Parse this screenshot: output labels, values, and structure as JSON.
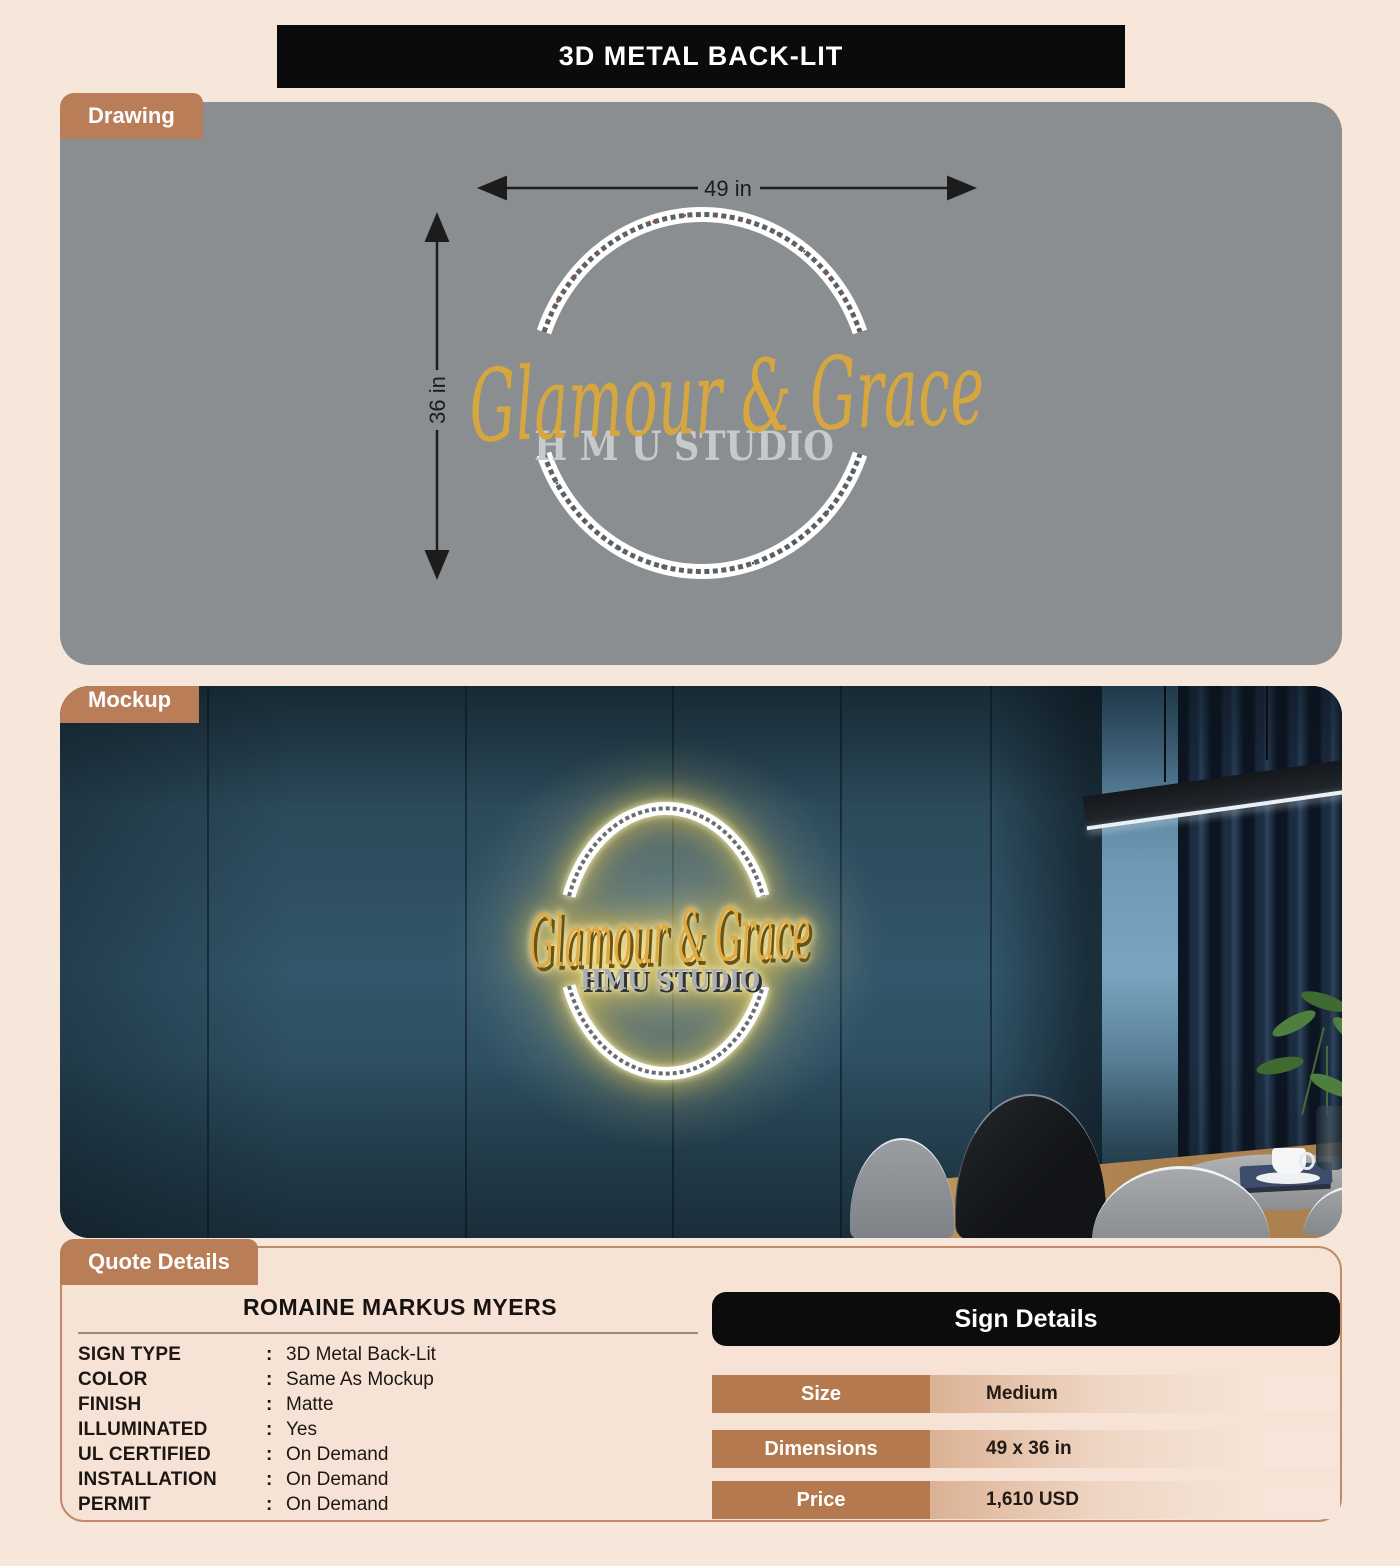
{
  "header": {
    "title": "3D METAL BACK-LIT"
  },
  "drawing": {
    "tab_label": "Drawing",
    "width_dim": "49 in",
    "height_dim": "36 in",
    "logo_script": "Glamour & Grace",
    "logo_subtitle": "H M U STUDIO"
  },
  "mockup": {
    "tab_label": "Mockup",
    "logo_script": "Glamour & Grace",
    "logo_subtitle": "HMU STUDIO"
  },
  "quote": {
    "tab_label": "Quote Details",
    "customer_name": "ROMAINE MARKUS MYERS",
    "separator": ":",
    "fields": [
      {
        "label": "SIGN TYPE",
        "value": "3D Metal Back-Lit"
      },
      {
        "label": "COLOR",
        "value": "Same As Mockup"
      },
      {
        "label": "FINISH",
        "value": "Matte"
      },
      {
        "label": "ILLUMINATED",
        "value": "Yes"
      },
      {
        "label": "UL CERTIFIED",
        "value": "On Demand"
      },
      {
        "label": "INSTALLATION",
        "value": "On Demand"
      },
      {
        "label": "PERMIT",
        "value": "On Demand"
      }
    ]
  },
  "sign_details": {
    "title": "Sign Details",
    "rows": [
      {
        "label": "Size",
        "value": "Medium"
      },
      {
        "label": "Dimensions",
        "value": "49 x 36 in"
      },
      {
        "label": "Price",
        "value": "1,610 USD"
      }
    ]
  },
  "colors": {
    "page_bg": "#f7e6da",
    "accent_brown": "#b97d58",
    "row_label_brown": "#b5794f",
    "panel_gray": "#8b8e90",
    "header_black": "#0b0b0b",
    "logo_gold": "#d5a73e",
    "wall_teal": "#2e4e5f"
  }
}
